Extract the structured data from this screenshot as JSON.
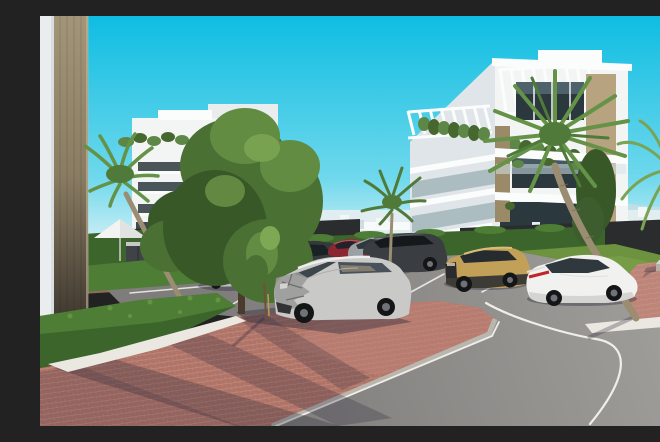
{
  "scene": {
    "type": "3d-architectural-exterior-render",
    "setting": "sunny coastal residential complex with parking and curving road",
    "description": "Sunny 3D architectural rendering of a modern white apartment complex under a vivid cyan sky. A white multi-storey building with rooftop pergolas, hanging plants, glass balconies and tan stone columns stands at the right; a second white building at the left is partly hidden by large green trees and palms. In the middle ground a parking area holds several cars including a silver SUV with a crashed front end, a white fastback sedan with a red tail-light bar, a tan compact SUV and several dark vehicles. Red brick paving, trimmed hedges, a white parasol with loungers, white gravel strips, a grass lawn with concrete benches and a grey asphalt road with white markings fill the foreground. A distant white skyline and faint mountains sit on the horizon behind a dark fence.",
    "visible_text": "none"
  },
  "palette": {
    "sky_top": "#0fbde2",
    "sky_mid": "#6fd8ec",
    "sky_horizon": "#cdeff6",
    "mountain": "#c9dde6",
    "skyline": "#e4edf0",
    "skyline_block": "#f4f8f9",
    "skyline_dark": "#ccd9dd",
    "bldg_white": "#f3f5f5",
    "bldg_bright": "#fbfcfc",
    "bldg_shade": "#e9edee",
    "bldg_side": "#dfe5e8",
    "stone_light": "#b7a37f",
    "stone_mid": "#9a8a68",
    "pillar_top": "#a39578",
    "pillar_mid": "#8a7c62",
    "pillar_bottom": "#37312a",
    "win_dark": "#2b383e",
    "win_glass": "#6f8b95",
    "glass_rail": "#d3e4e9",
    "plant": "#5d8746",
    "plant_dark": "#46682f",
    "tree": "#4b7034",
    "tree_light": "#628c42",
    "tree_dark": "#395827",
    "tree_lighter": "#7ea853",
    "hedge": "#3c652c",
    "hedge_light": "#4e7d35",
    "hedge_top": "#6a9a45",
    "grass": "#6d9340",
    "grass_light": "#7fa24c",
    "palm": "#649347",
    "palm_dark": "#4f7a39",
    "palm_light": "#7aa355",
    "trunk": "#9b8d72",
    "trunk_dark": "#7a6c52",
    "fence": "#2b2c2e",
    "asph_light": "#a3a19d",
    "asph_dark": "#7e7d7b",
    "brick": "#b07467",
    "brick_light": "#c99c93",
    "brick_sun": "#bd8478",
    "walkway": "#96705f",
    "walkway2": "#8f6a5e",
    "gravel": "#eae8e1",
    "curb": "#b9b6ae",
    "line_white": "#efeee9",
    "shadow": "#2e2a3c",
    "bench_top": "#d8d5ce",
    "bench_side": "#b4b0a7",
    "dry_plant": "#c09a55",
    "car_black": "#202225",
    "car_teal": "#3f6a72",
    "car_silver": "#b9bcbd",
    "car_dark_suv": "#35383c",
    "car_red": "#8c2732",
    "car_grey": "#9aa0a3",
    "car_big_dark": "#3a3d41",
    "car_tan": "#c3a057",
    "car_tan_trim": "#2f3032",
    "car_white": "#f1f1ef",
    "car_white_shade": "#cfcfcc",
    "car_damaged": "#c9cac8",
    "damage_grey": "#999a97",
    "damage_dark": "#323335",
    "wheel": "#141517",
    "hub": "#6f7276",
    "tail_red": "#c0252c",
    "car_glass": "#2f383d"
  },
  "objects": {
    "background": [
      {
        "name": "sky",
        "detail": "clear cyan gradient sky"
      },
      {
        "name": "mountains",
        "detail": "faint pale mountain ridge on right horizon"
      },
      {
        "name": "city-skyline",
        "detail": "distant low white buildings along horizon"
      }
    ],
    "buildings": [
      {
        "name": "main-building",
        "detail": "white modern block, right side; rooftop pergolas, hanging plants, glass balconies, tan stone columns, dark glazing"
      },
      {
        "name": "left-building",
        "detail": "white modern block behind trees with roof planting and tan column"
      },
      {
        "name": "foreground-corner",
        "detail": "close-up building corner at far left: white wall and tan stone pillar"
      }
    ],
    "vegetation": [
      {
        "name": "palm-left",
        "detail": "palm with curved trunk by left building"
      },
      {
        "name": "palm-center",
        "detail": "small palm behind parking row"
      },
      {
        "name": "palm-fan-large",
        "detail": "tall fan palm in front of main building"
      },
      {
        "name": "palm-right",
        "detail": "feather palm at right edge"
      },
      {
        "name": "tree-large",
        "detail": "large green tree center-left"
      },
      {
        "name": "tree-small",
        "detail": "second tree left of parking"
      },
      {
        "name": "sapling",
        "detail": "young staked tree in brick apron"
      },
      {
        "name": "hedges",
        "detail": "trimmed dark-green hedge rows, large diagonal hedge bottom-left"
      },
      {
        "name": "lawn",
        "detail": "grass area right with dry golden plant"
      }
    ],
    "street_furniture": [
      {
        "name": "parasol",
        "detail": "white patio umbrella with loungers"
      },
      {
        "name": "outdoor-counter",
        "detail": "dark grey cabinet unit near parasol"
      },
      {
        "name": "benches",
        "detail": "two concrete benches on right plaza"
      }
    ],
    "ground": [
      {
        "name": "road",
        "detail": "grey asphalt curving from bottom left to right with white edge and lane lines"
      },
      {
        "name": "parking",
        "detail": "asphalt bays with white dividers"
      },
      {
        "name": "brick-paving",
        "detail": "red clay paver plaza and walkways with long tree shadows"
      },
      {
        "name": "gravel-strips",
        "detail": "white gravel borders along hedge and lawn"
      }
    ],
    "vehicles": [
      {
        "name": "car-black",
        "color": "black",
        "position": "far left behind hedge"
      },
      {
        "name": "car-teal",
        "color": "dark teal",
        "position": "behind small tree"
      },
      {
        "name": "car-silver-sedan",
        "color": "silver",
        "position": "left parking row"
      },
      {
        "name": "car-dark-suv",
        "color": "dark grey",
        "position": "behind damaged SUV"
      },
      {
        "name": "car-red",
        "color": "dark red",
        "position": "middle row"
      },
      {
        "name": "car-grey-sedan",
        "color": "grey",
        "position": "middle row"
      },
      {
        "name": "car-large-dark-suv",
        "color": "charcoal",
        "position": "middle row right"
      },
      {
        "name": "car-tan-suv",
        "color": "tan/gold compact SUV",
        "position": "right row"
      },
      {
        "name": "car-white-sedan",
        "color": "white fastback with red tail-light bar",
        "position": "right row"
      },
      {
        "name": "car-damaged-suv",
        "color": "silver",
        "state": "crashed crumpled front end",
        "position": "foreground center"
      }
    ]
  }
}
